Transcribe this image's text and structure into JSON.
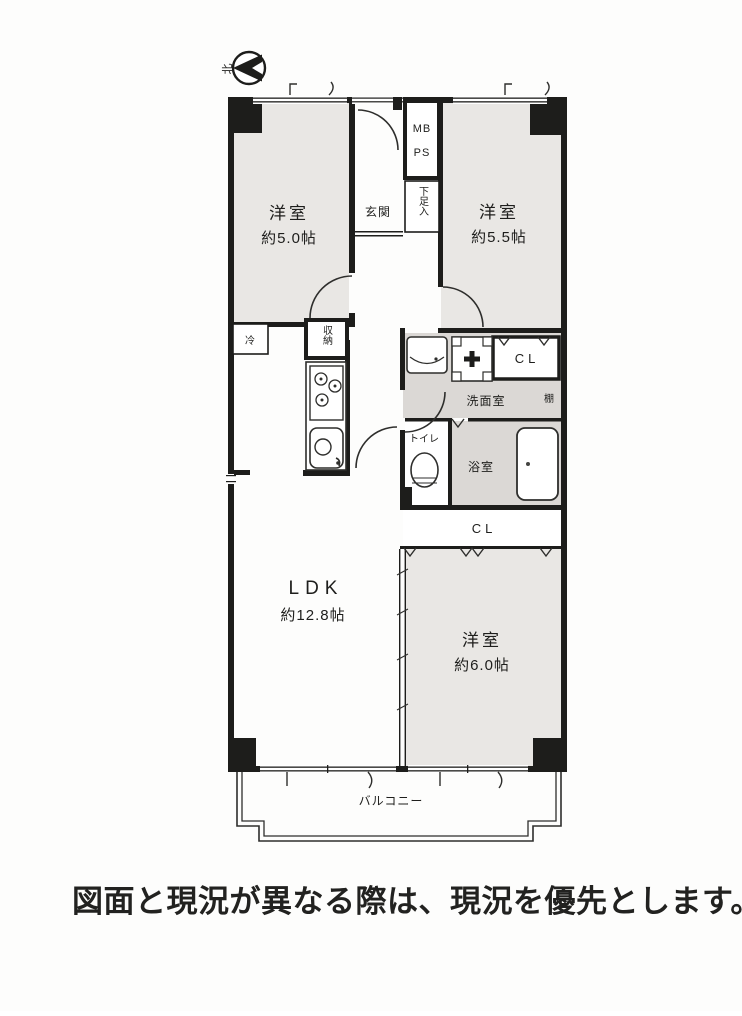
{
  "compass": {
    "north": "北"
  },
  "floor_plan": {
    "rooms": {
      "bedroom_nw": {
        "name": "洋室",
        "size": "約5.0帖"
      },
      "bedroom_ne": {
        "name": "洋室",
        "size": "約5.5帖"
      },
      "bedroom_se": {
        "name": "洋室",
        "size": "約6.0帖"
      },
      "ldk": {
        "name": "LDK",
        "size": "約12.8帖"
      },
      "entrance": {
        "name": "玄関"
      },
      "washroom": {
        "name": "洗面室"
      },
      "bathroom": {
        "name": "浴室"
      },
      "toilet": {
        "name": "トイレ"
      },
      "balcony": {
        "name": "バルコニー"
      }
    },
    "fixtures": {
      "meter_box": "MB",
      "pipe_space": "PS",
      "shoe_cabinet": "下足入",
      "hall_storage": "収納",
      "refrigerator": "冷",
      "upper_closet": "CL",
      "lower_closet": "CL",
      "shelf": "棚"
    }
  },
  "caption": "図面と現況が異なる際は、現況を優先とします。"
}
